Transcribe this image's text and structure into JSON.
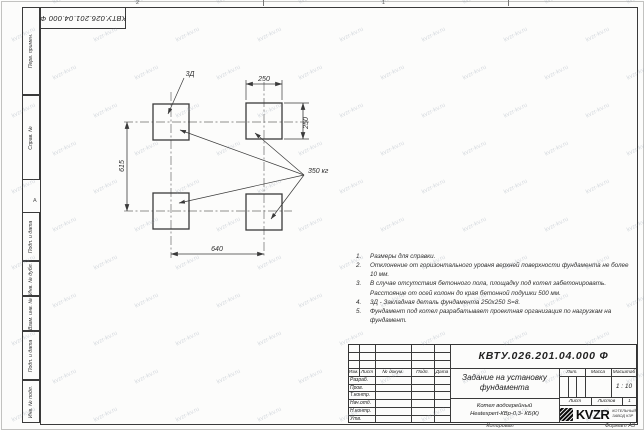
{
  "watermark": {
    "text": "kvzr-kv.ru"
  },
  "sheet": {
    "doc_number_top": "КВТУ.026.201.04.000 Ф",
    "zone_top_1": "2",
    "zone_top_2": "1",
    "zone_left": "А",
    "copied_label": "Копировал",
    "format_label": "Формат А3"
  },
  "margin": {
    "perv": "Перв. примен.",
    "sprav": "Справ. №",
    "podp1": "Подп. и дата",
    "inv_dubl": "Инв. № дубл.",
    "vzam": "Взам. инв. №",
    "podp2": "Подп. и дата",
    "inv_podl": "Инв. № подл."
  },
  "drawing": {
    "dim_width_top": "250",
    "dim_height_right": "250",
    "dim_left": "615",
    "dim_bottom": "640",
    "weight": "350 кг",
    "embed": "3Д"
  },
  "notes": {
    "items": [
      {
        "num": "1.",
        "text": "Размеры для справки."
      },
      {
        "num": "2.",
        "text": "Отклонение от горизонтального уровня верхней поверхности фундамента не более 10 мм."
      },
      {
        "num": "3.",
        "text": "В случае отсутствия бетонного пола, площадку под котел забетонировать. Расстояние от осей колонн до края бетонной подушки 500 мм."
      },
      {
        "num": "4.",
        "text": "3Д - Закладная деталь фундамента 250х250 S=8."
      },
      {
        "num": "5.",
        "text": "Фундамент под котел разрабатывает проектная организация по нагрузкам на фундамент."
      }
    ]
  },
  "title_block": {
    "doc_number": "КВТУ.026.201.04.000 Ф",
    "title_line1": "Задание на установку",
    "title_line2": "фундамента",
    "product_line1": "Котел водогрейный",
    "product_line2": "Heatexpert-КВр-0,3- КБ(К)",
    "col_izm": "Изм.",
    "col_list": "Лист",
    "col_doc": "№ докум.",
    "col_podp": "Подп.",
    "col_data": "Дата",
    "rows": [
      "Разраб.",
      "Пров.",
      "Т.контр.",
      "Нач.отд.",
      "Н.контр.",
      "Утв."
    ],
    "lit": "Лит.",
    "mass": "Масса",
    "scale": "Масштаб",
    "scale_value": "1 : 10",
    "sheet": "Лист",
    "sheets": "Листов",
    "sheets_value": "1",
    "logo": "KVZR",
    "logo_line1": "КОТЕЛЬНЫЙ",
    "logo_line2": "ЗАВОД КЗР"
  }
}
